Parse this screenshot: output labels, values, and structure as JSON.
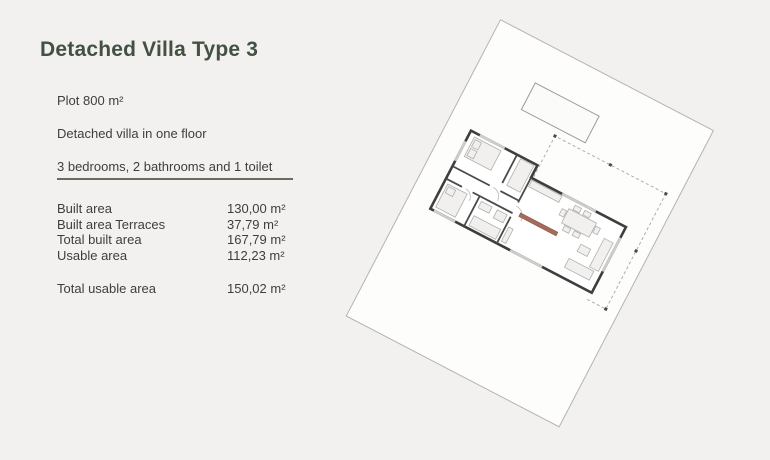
{
  "page": {
    "background_color": "#f2f1ef",
    "title_color": "#425141"
  },
  "header": {
    "title": "Detached Villa Type 3"
  },
  "summary": {
    "lines": [
      "Plot 800 m²",
      "Detached villa in one floor",
      "3 bedrooms, 2 bathrooms and 1 toilet"
    ]
  },
  "areas": {
    "rows": [
      {
        "label": "Built area",
        "value": "130,00 m²"
      },
      {
        "label": "Built area Terraces",
        "value": "37,79 m²"
      },
      {
        "label": "Total built area",
        "value": "167,79 m²"
      },
      {
        "label": "Usable area",
        "value": "112,23 m²"
      }
    ],
    "total": {
      "label": "Total usable area",
      "value": "150,02 m²"
    }
  },
  "floor_plan": {
    "description": "Rotated site plan of detached villa plot with pool, house floor plan and dashed terrace outline",
    "rotation_deg": 27.5,
    "elements": [
      "plot-boundary",
      "pool",
      "terrace-outline",
      "terrace-columns",
      "house-exterior-walls",
      "house-interior-walls",
      "house-windows",
      "furniture",
      "kitchen-counter-highlight"
    ],
    "colors": {
      "plot_line": "#b6b3ae",
      "pool_line": "#9f9c97",
      "walls": "#3e3e3e",
      "dashed_terrace": "#a8a6a2",
      "counter_highlight": "#a46b5b"
    }
  }
}
